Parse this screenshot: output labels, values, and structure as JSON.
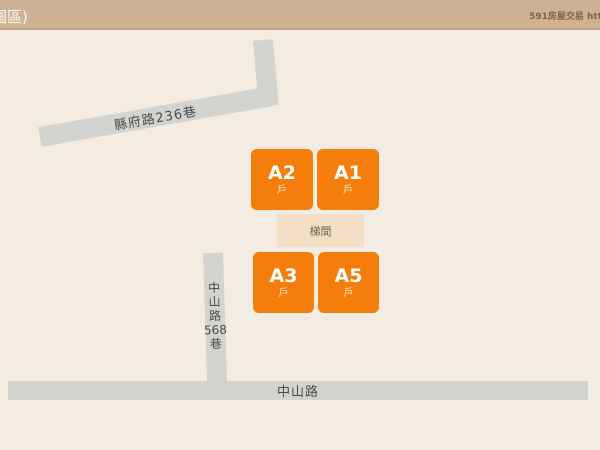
{
  "header": {
    "title_partial": "圖區)",
    "watermark": "591房屋交易 htt",
    "bg_color": "#CEB295",
    "border_color": "#C2A483"
  },
  "map": {
    "bg_color": "#F2ECE3",
    "road_color": "#D3D3CF",
    "unit_color": "#F57D0C",
    "stair_color": "#F3DEC6",
    "roads": {
      "county_lane": {
        "label": "縣府路236巷"
      },
      "mountain_lane": {
        "label": "中山路568巷",
        "chars": [
          "中",
          "山",
          "路",
          "568",
          "巷"
        ]
      },
      "main_road": {
        "label": "中山路"
      }
    },
    "stairwell": {
      "label": "梯間"
    },
    "units": [
      {
        "id": "A2",
        "sub": "戶"
      },
      {
        "id": "A1",
        "sub": "戶"
      },
      {
        "id": "A3",
        "sub": "戶"
      },
      {
        "id": "A5",
        "sub": "戶"
      }
    ]
  }
}
